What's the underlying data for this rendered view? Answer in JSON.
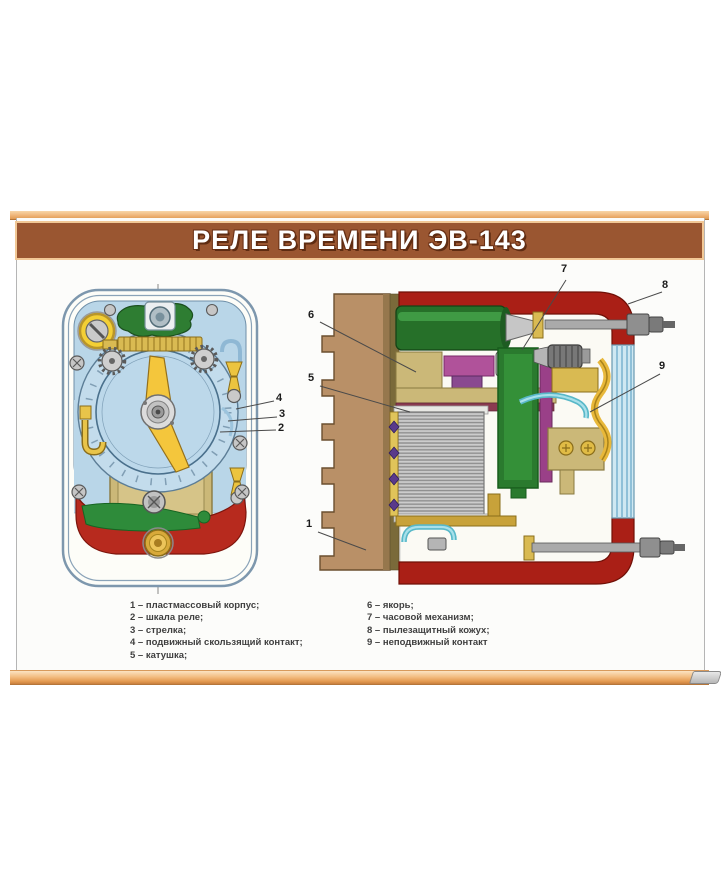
{
  "poster": {
    "title": "РЕЛЕ ВРЕМЕНИ ЭВ-143"
  },
  "legend": {
    "left": [
      "1 – пластмассовый корпус;",
      "2 – шкала реле;",
      "3 – стрелка;",
      "4 – подвижный скользящий контакт;",
      "5 – катушка;"
    ],
    "right": [
      "6 – якорь;",
      "7 – часовой механизм;",
      "8 – пылезащитный кожух;",
      "9 – неподвижный контакт"
    ]
  },
  "callouts": {
    "c1": "1",
    "c2": "2",
    "c3": "3",
    "c4": "4",
    "c5": "5",
    "c6": "6",
    "c7": "7",
    "c8": "8",
    "c9": "9"
  },
  "colors": {
    "header_brown": "#9a5631",
    "rail_peach": "#f2c08c",
    "case_blue": "#b9d6e8",
    "base_red": "#b22b20",
    "cover_red": "#aa1f16",
    "bracket_tan": "#b99067",
    "mechanism_green": "#2a7a2e",
    "brass_yellow": "#d9ba52"
  }
}
